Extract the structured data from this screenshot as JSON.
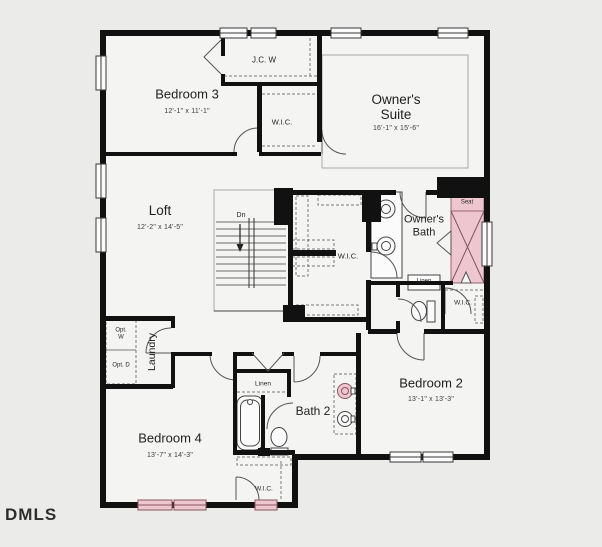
{
  "watermark": "DMLS",
  "rooms": {
    "bedroom3": {
      "name": "Bedroom 3",
      "dims": "12'-1\" x 11'-1\""
    },
    "owners_suite": {
      "line1": "Owner's",
      "line2": "Suite",
      "dims": "16'-1\" x 15'-6\""
    },
    "loft": {
      "name": "Loft",
      "dims": "12'-2\" x 14'-5\""
    },
    "owners_bath": {
      "line1": "Owner's",
      "line2": "Bath"
    },
    "bedroom2": {
      "name": "Bedroom 2",
      "dims": "13'-1\" x 13'-3\""
    },
    "bath2": {
      "name": "Bath 2"
    },
    "bedroom4": {
      "name": "Bedroom 4",
      "dims": "13'-7\" x 14'-3\""
    },
    "laundry": {
      "name": "Laundry",
      "opt_washer": "Opt. W",
      "opt_dryer": "Opt. D"
    }
  },
  "closets": {
    "jcw": "J.C. W",
    "wic": "W.I.C.",
    "linen": "Linen"
  },
  "annotations": {
    "down": "Dn",
    "seat": "Seat"
  },
  "colors": {
    "background": "#ebebea",
    "floor": "#f4f4f3",
    "wall": "#111111",
    "highlight_pink": "#eec6cf",
    "highlight_border": "#9a6472",
    "window_white": "#fbfbfb"
  }
}
